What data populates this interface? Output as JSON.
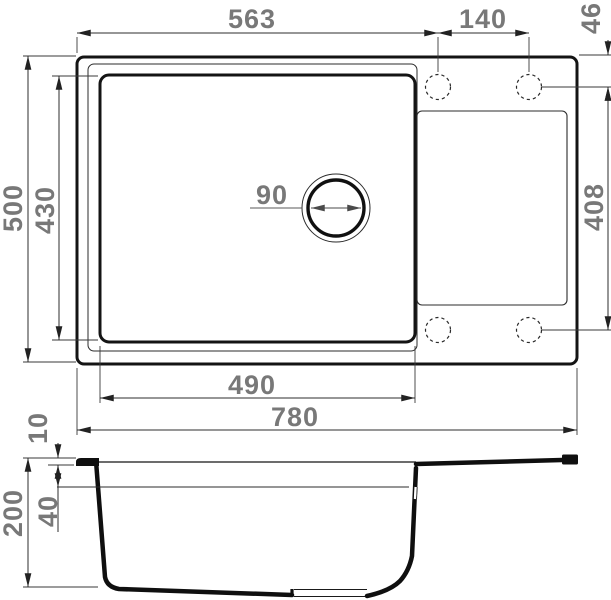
{
  "drawing": {
    "kind": "sink technical drawing",
    "views": {
      "top": "plan view",
      "bottom": "cross-section view"
    },
    "colors": {
      "background": "#ffffff",
      "outline": "#141414",
      "dimension_line": "#2e2e2e",
      "dimension_text": "#787878"
    }
  },
  "dimensions": {
    "top_view": {
      "left_edge_to_tap_hole": "563",
      "tap_hole_spacing": "140",
      "tap_hole_to_top_edge": "46",
      "overall_depth": "500",
      "bowl_inner_depth": "430",
      "drain_hole_diameter": "90",
      "drainboard_length": "408",
      "bowl_inner_width": "490",
      "overall_width": "780"
    },
    "section_view": {
      "rim_lip_height": "10",
      "ledge_depth": "40",
      "overall_height": "200"
    }
  }
}
